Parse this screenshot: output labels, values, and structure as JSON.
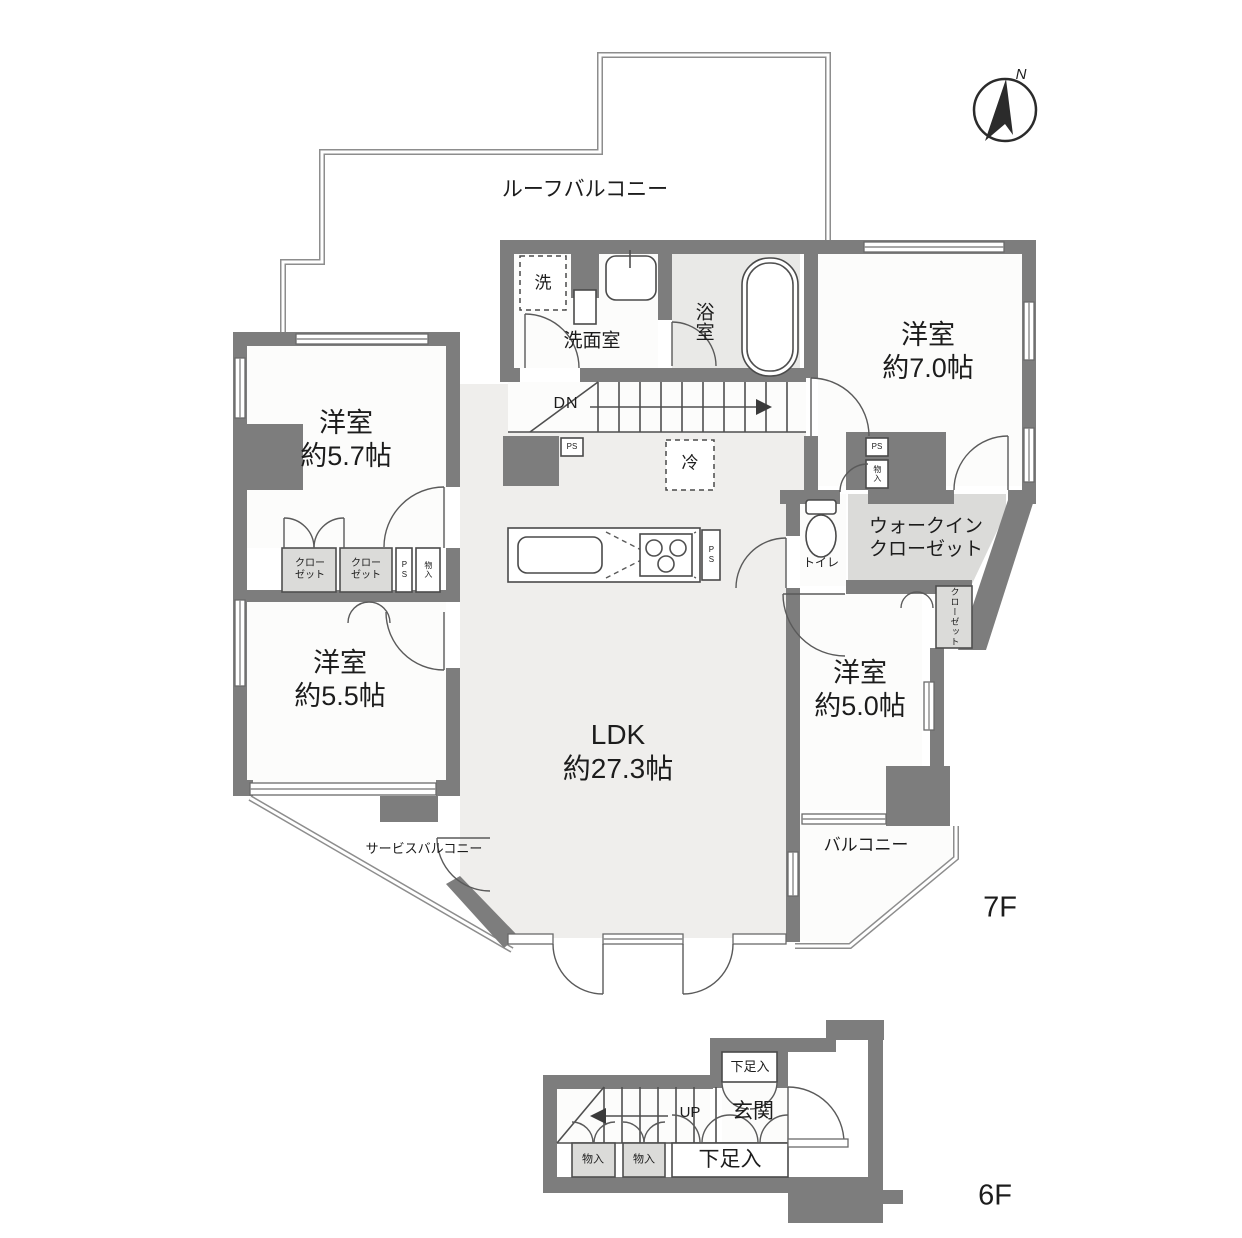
{
  "compass": {
    "north": "N"
  },
  "floor_labels": {
    "f7": "7F",
    "f6": "6F"
  },
  "outdoor": {
    "roof_balcony": "ルーフバルコニー",
    "service_balcony": "サービスバルコニー",
    "balcony": "バルコニー"
  },
  "rooms": {
    "bedroom_7": {
      "name": "洋室",
      "size": "約7.0帖"
    },
    "bedroom_5_7": {
      "name": "洋室",
      "size": "約5.7帖"
    },
    "bedroom_5_5": {
      "name": "洋室",
      "size": "約5.5帖"
    },
    "bedroom_5_0": {
      "name": "洋室",
      "size": "約5.0帖"
    },
    "ldk": {
      "name": "LDK",
      "size": "約27.3帖"
    },
    "washroom": "洗面室",
    "bathroom": "浴室",
    "toilet": "トイレ",
    "wic": {
      "line1": "ウォークイン",
      "line2": "クローゼット"
    },
    "entrance": "玄関"
  },
  "storage": {
    "closet_line1": "クロー",
    "closet_line2": "ゼット",
    "closet_full": "クローゼット",
    "storage_small": "物入",
    "shoe_cabinet": "下足入",
    "pipe_space": "PS"
  },
  "appliances": {
    "washer": "洗",
    "fridge": "冷"
  },
  "stairs": {
    "down": "DN",
    "up": "UP"
  },
  "colors": {
    "wall": "#7d7d7d",
    "shade": "#dbdbd9",
    "ldk_floor": "#efeeec",
    "text": "#1c1c1c"
  }
}
